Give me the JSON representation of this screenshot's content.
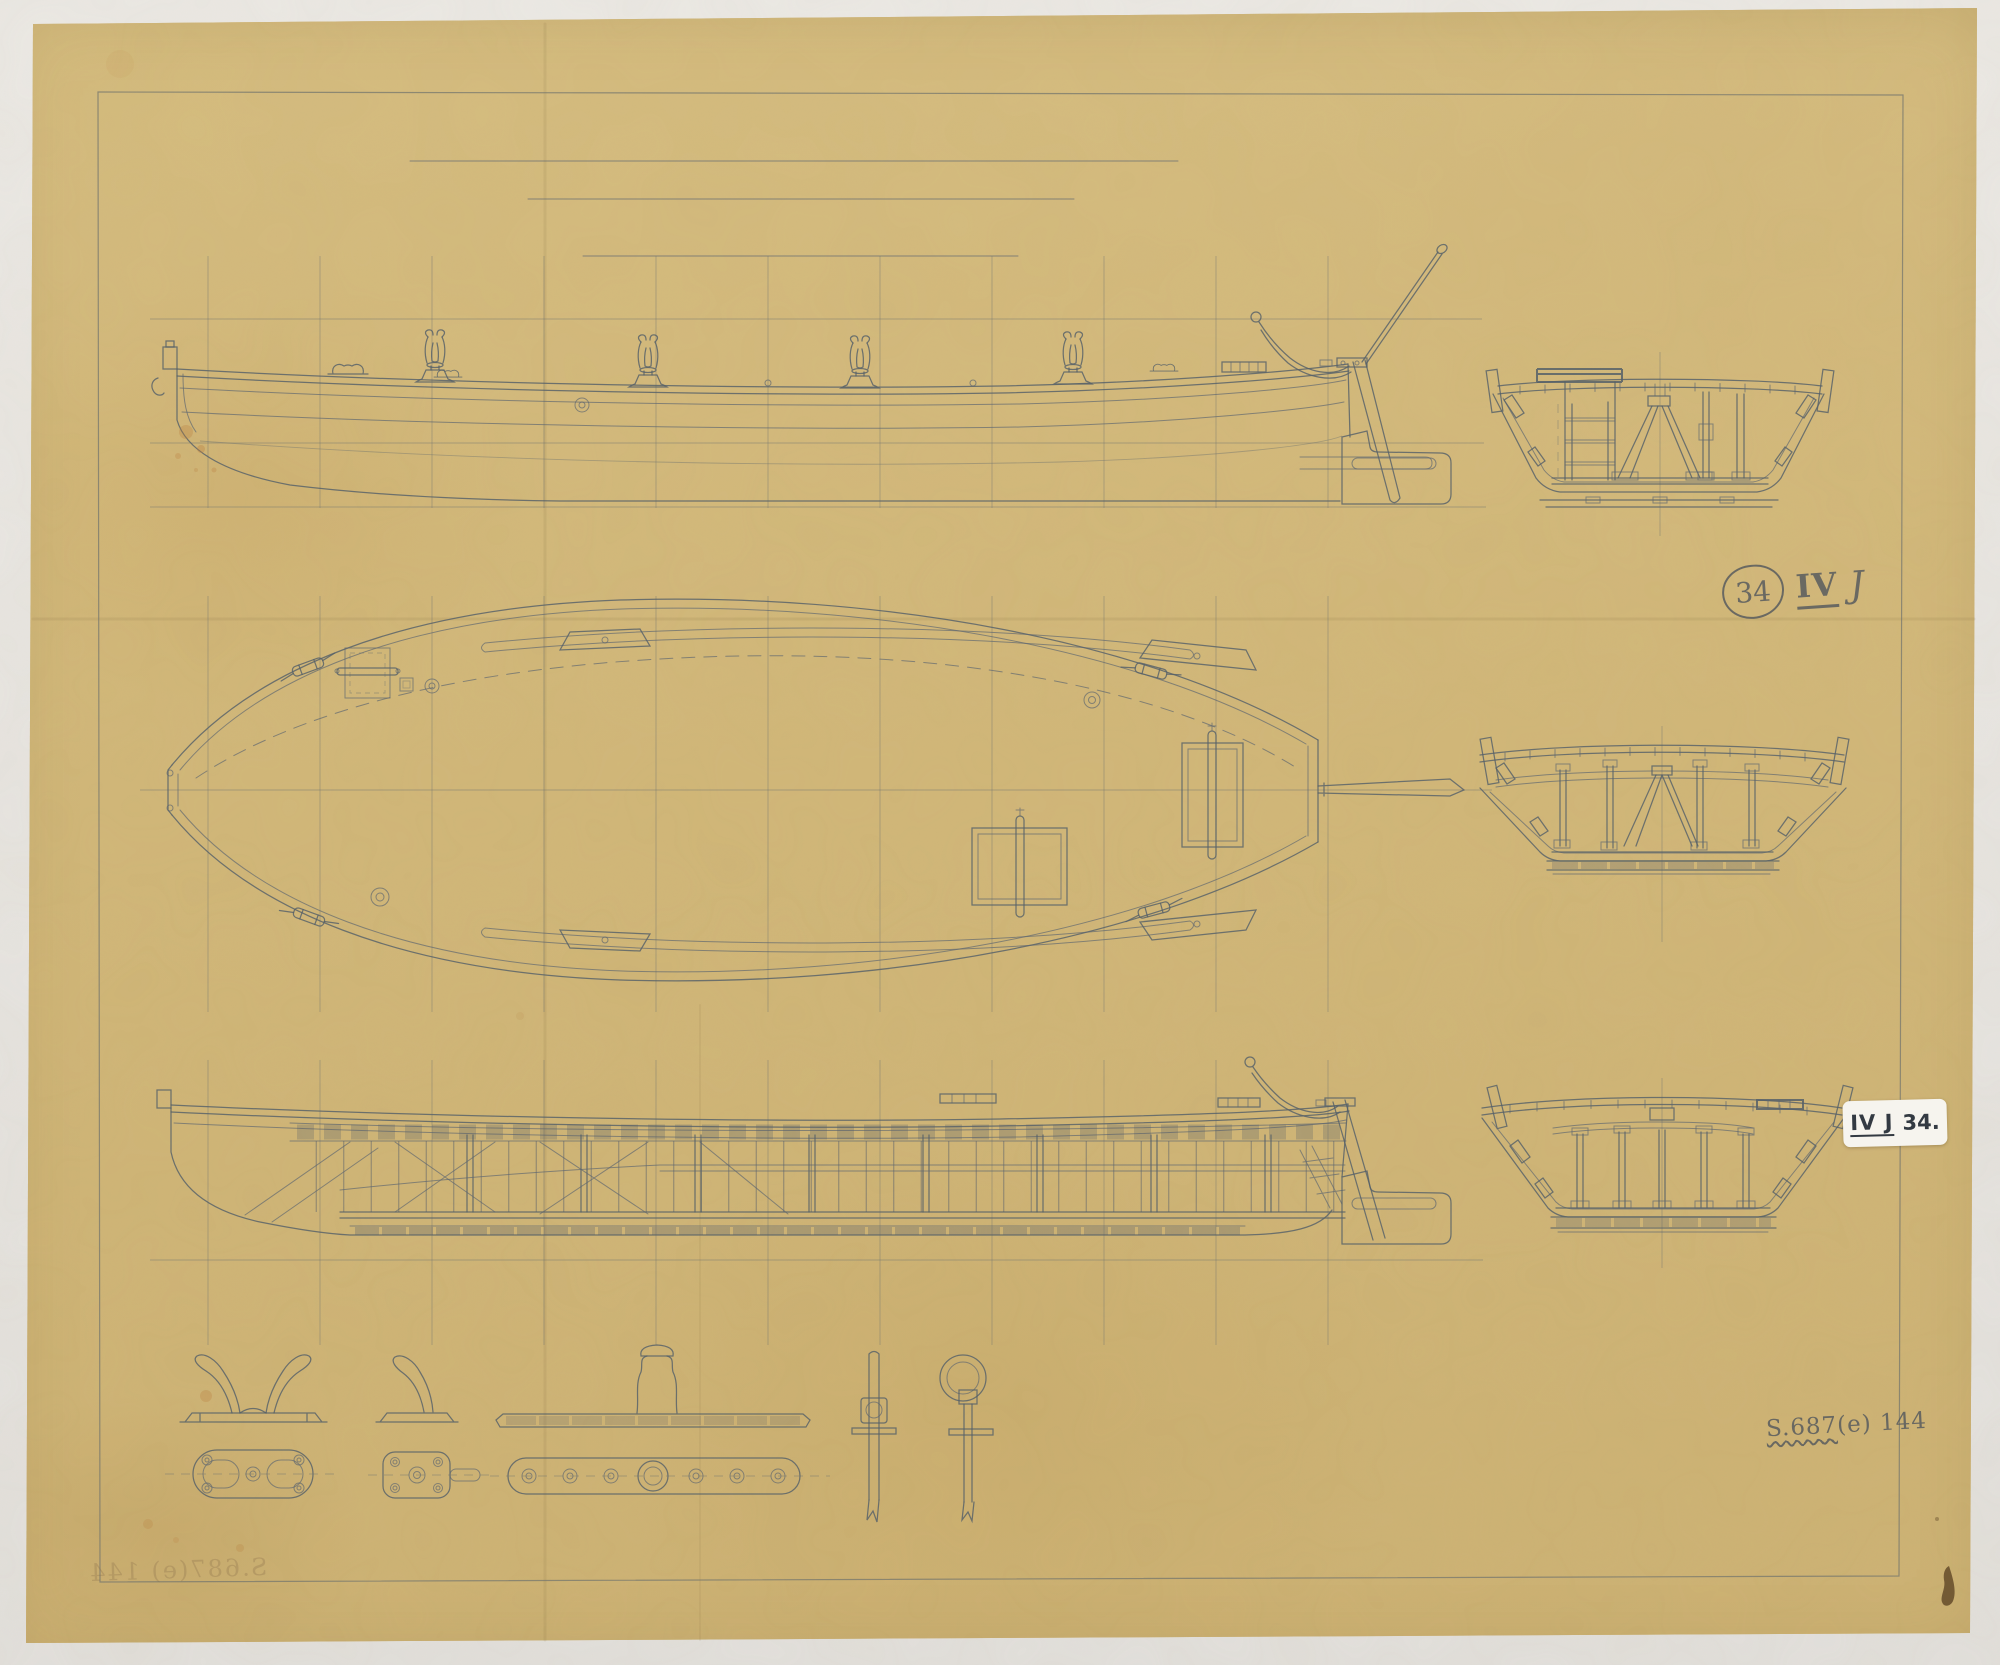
{
  "annotations": {
    "circled_number": "34",
    "series_roman": "IV",
    "series_letter": "J",
    "label_code": "IV J",
    "label_number": "34.",
    "reference_part1": "S.687",
    "reference_part2": "(e) 144",
    "bleedthrough_text": "S.687(e) 144"
  },
  "colors": {
    "photo_background": "#e8e6e2",
    "paper": "#d2b87a",
    "pencil": "#566069",
    "label_background": "#f6f4ee",
    "ink_smudge": "#5e4526"
  }
}
